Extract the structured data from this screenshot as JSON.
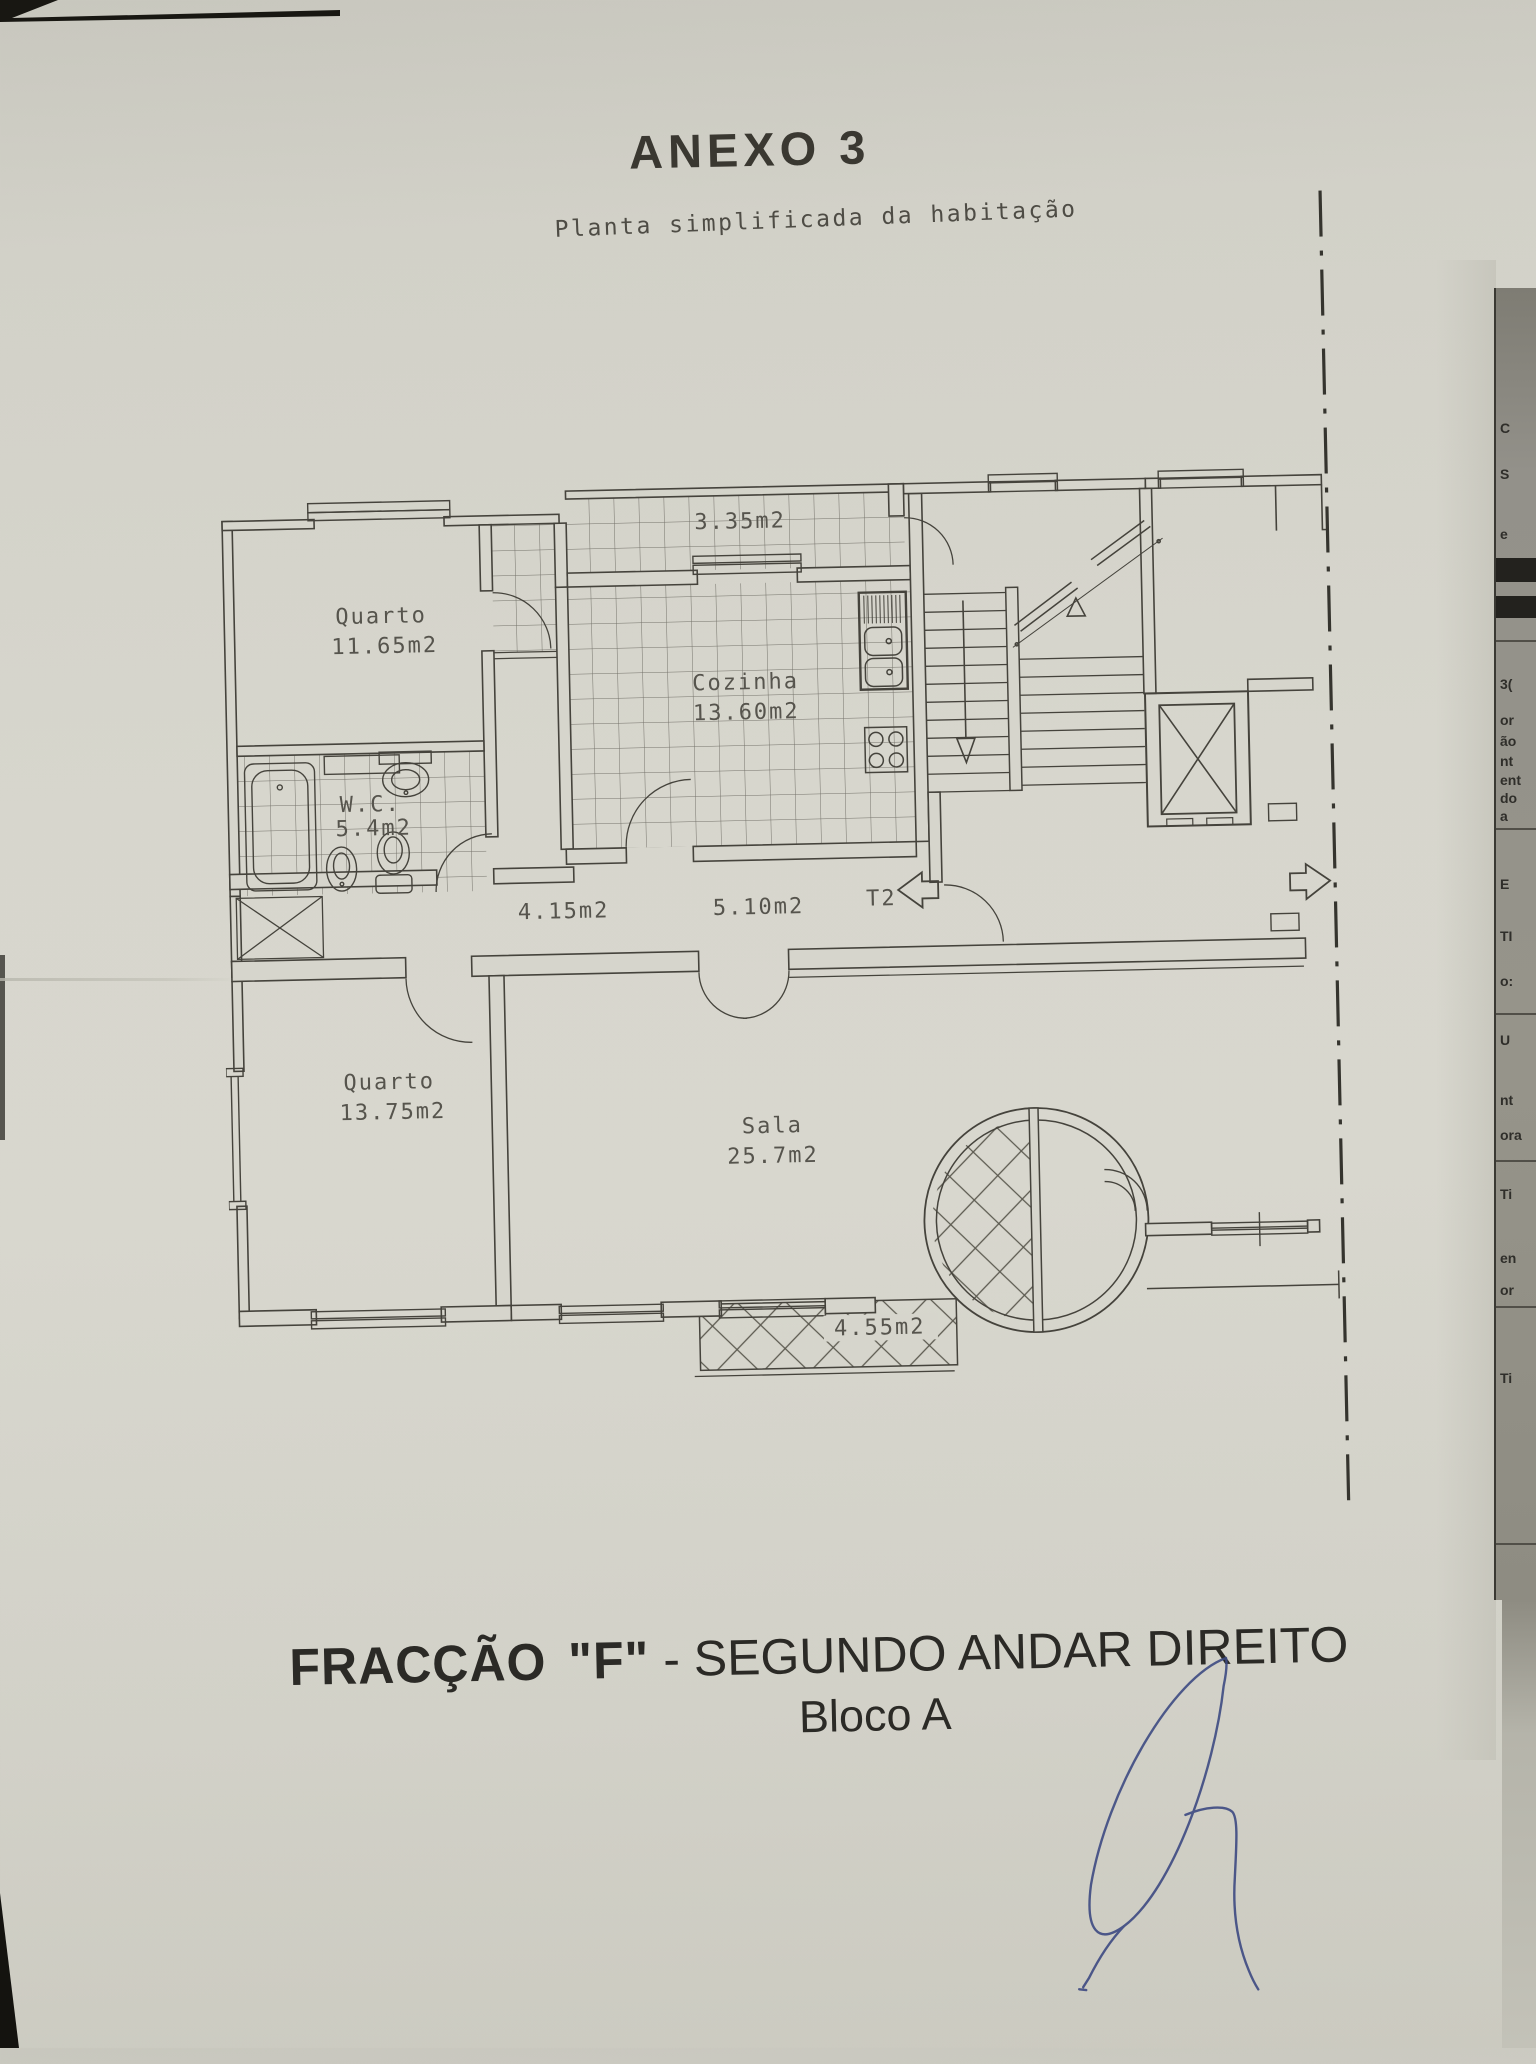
{
  "page": {
    "title": "ANEXO 3",
    "subtitle": "Planta simplificada da habitação",
    "caption": {
      "fraction_bold": "FRACÇÃO",
      "fraction_quote": "\"F\"",
      "fraction_rest": " - SEGUNDO ANDAR DIREITO",
      "block": "Bloco A"
    }
  },
  "plan": {
    "rooms": [
      {
        "id": "bedroom-1",
        "name": "Quarto",
        "area": "11.65m2"
      },
      {
        "id": "kitchen",
        "name": "Cozinha",
        "area": "13.60m2"
      },
      {
        "id": "bathroom",
        "name": "W.C.",
        "area": "5.4m2"
      },
      {
        "id": "bedroom-2",
        "name": "Quarto",
        "area": "13.75m2"
      },
      {
        "id": "living-room",
        "name": "Sala",
        "area": "25.7m2"
      }
    ],
    "areas": {
      "balcony_top": "3.35m2",
      "hall": "4.15m2",
      "corridor": "5.10m2",
      "balcony_bottom": "4.55m2"
    },
    "typology": "T2"
  },
  "edge_fragments": [
    {
      "t": "C",
      "y": 420
    },
    {
      "t": "S",
      "y": 466
    },
    {
      "t": "e",
      "y": 526
    },
    {
      "t": "3(",
      "y": 676
    },
    {
      "t": "or",
      "y": 712
    },
    {
      "t": "ão",
      "y": 733
    },
    {
      "t": "nt",
      "y": 753
    },
    {
      "t": "ent",
      "y": 772
    },
    {
      "t": "do",
      "y": 790
    },
    {
      "t": "a",
      "y": 808
    },
    {
      "t": "E",
      "y": 876
    },
    {
      "t": "TI",
      "y": 928
    },
    {
      "t": "o:",
      "y": 973
    },
    {
      "t": "U",
      "y": 1032
    },
    {
      "t": "nt",
      "y": 1092
    },
    {
      "t": "ora",
      "y": 1127
    },
    {
      "t": "Ti",
      "y": 1186
    },
    {
      "t": "en",
      "y": 1250
    },
    {
      "t": "or",
      "y": 1282
    },
    {
      "t": "Ti",
      "y": 1370
    }
  ],
  "colors": {
    "paper": "#d6d5cc",
    "plan_ink": "#45433c",
    "label_ink": "#56544d",
    "heading_ink": "#33322c",
    "signature_blue": "#3d4a82",
    "underlay_page": "#93918a"
  }
}
